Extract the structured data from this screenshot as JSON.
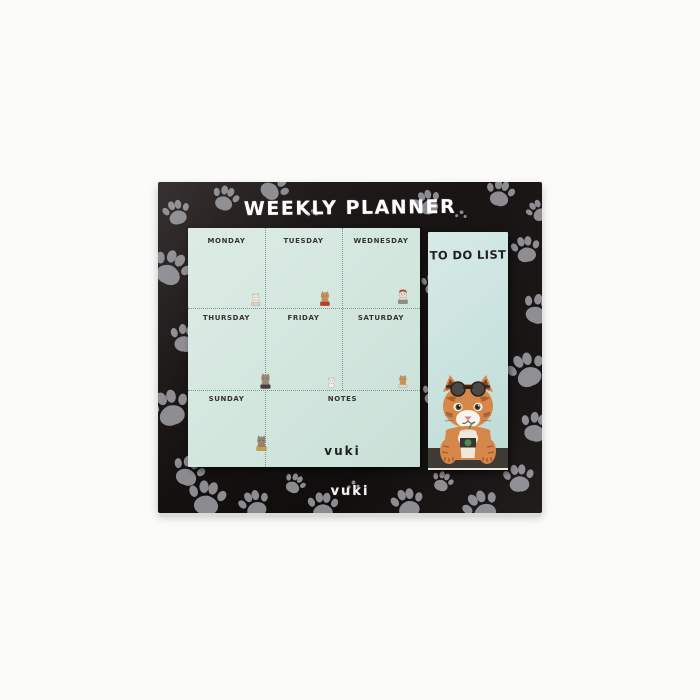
{
  "board": {
    "title": "WEEKLY PLANNER",
    "brand": "vuki"
  },
  "planner": {
    "days": [
      "MONDAY",
      "TUESDAY",
      "WEDNESDAY",
      "THURSDAY",
      "FRIDAY",
      "SATURDAY",
      "SUNDAY"
    ],
    "notes_label": "NOTES",
    "brand": "vuki"
  },
  "todo": {
    "title": "TO DO LIST"
  },
  "colors": {
    "board_background": "#151111",
    "paw_gray": "#8c8b90",
    "planner_pad": "#d3e6de",
    "todo_pad": "#c9e2de",
    "todo_band": "#3e3a35",
    "title_white": "#ffffff",
    "label_dark": "#35342f",
    "cat_orange": "#d6874a",
    "cup_label_green": "#4d8b57"
  },
  "decor": {
    "paws": [
      {
        "x": 4,
        "y": 16,
        "s": 30,
        "r": -15,
        "t": "paw"
      },
      {
        "x": -8,
        "y": 66,
        "s": 42,
        "r": 25,
        "t": "paw"
      },
      {
        "x": 10,
        "y": 140,
        "s": 34,
        "r": 8,
        "t": "paw"
      },
      {
        "x": -10,
        "y": 205,
        "s": 44,
        "r": -18,
        "t": "paw"
      },
      {
        "x": 12,
        "y": 272,
        "s": 36,
        "r": 20,
        "t": "paw"
      },
      {
        "x": 52,
        "y": 2,
        "s": 30,
        "r": 18,
        "t": "paw"
      },
      {
        "x": 98,
        "y": -12,
        "s": 34,
        "r": 40,
        "t": "paw"
      },
      {
        "x": 148,
        "y": 22,
        "s": 13,
        "r": 0,
        "t": "dots"
      },
      {
        "x": 255,
        "y": 6,
        "s": 30,
        "r": -22,
        "t": "paw"
      },
      {
        "x": 296,
        "y": 24,
        "s": 14,
        "r": 10,
        "t": "dots"
      },
      {
        "x": 326,
        "y": -4,
        "s": 32,
        "r": 12,
        "t": "paw"
      },
      {
        "x": 368,
        "y": 16,
        "s": 26,
        "r": -30,
        "t": "paw"
      },
      {
        "x": 352,
        "y": 52,
        "s": 32,
        "r": -10,
        "t": "paw"
      },
      {
        "x": 362,
        "y": 110,
        "s": 36,
        "r": 22,
        "t": "paw"
      },
      {
        "x": 348,
        "y": 168,
        "s": 42,
        "r": -22,
        "t": "paw"
      },
      {
        "x": 360,
        "y": 228,
        "s": 36,
        "r": 14,
        "t": "paw"
      },
      {
        "x": 344,
        "y": 280,
        "s": 34,
        "r": -6,
        "t": "paw"
      },
      {
        "x": 28,
        "y": 296,
        "s": 42,
        "r": 8,
        "t": "paw"
      },
      {
        "x": 80,
        "y": 306,
        "s": 34,
        "r": -20,
        "t": "paw"
      },
      {
        "x": 124,
        "y": 290,
        "s": 24,
        "r": 28,
        "t": "paw"
      },
      {
        "x": 148,
        "y": 308,
        "s": 34,
        "r": 0,
        "t": "paw"
      },
      {
        "x": 188,
        "y": 294,
        "s": 15,
        "r": 0,
        "t": "dots"
      },
      {
        "x": 232,
        "y": 304,
        "s": 36,
        "r": -14,
        "t": "paw"
      },
      {
        "x": 272,
        "y": 288,
        "s": 24,
        "r": 20,
        "t": "paw"
      },
      {
        "x": 304,
        "y": 306,
        "s": 40,
        "r": -28,
        "t": "paw"
      },
      {
        "x": 262,
        "y": 90,
        "s": 26,
        "r": 0,
        "t": "paw"
      },
      {
        "x": 262,
        "y": 200,
        "s": 26,
        "r": 15,
        "t": "paw"
      }
    ],
    "stickers": [
      {
        "x": 60,
        "y": 64,
        "s": 15,
        "body": "#f1ece2",
        "acc": "#d9d2c4",
        "hat": null,
        "name": "white-cat-sticker"
      },
      {
        "x": 128,
        "y": 62,
        "s": 17,
        "body": "#cb9154",
        "acc": "#c23b2a",
        "hat": null,
        "name": "reading-cat-sticker"
      },
      {
        "x": 206,
        "y": 60,
        "s": 17,
        "body": "#e8dfd2",
        "acc": "#8e8d89",
        "hat": "#b0462c",
        "name": "red-hat-cat-sticker"
      },
      {
        "x": 68,
        "y": 144,
        "s": 18,
        "body": "#9c8a76",
        "acc": "#46413c",
        "hat": null,
        "name": "laptop-cat-sticker"
      },
      {
        "x": 136,
        "y": 147,
        "s": 14,
        "body": "#f3efe6",
        "acc": null,
        "hat": null,
        "name": "white-cat-sticker"
      },
      {
        "x": 207,
        "y": 146,
        "s": 15,
        "body": "#cf9357",
        "acc": "#e3d7c4",
        "hat": null,
        "name": "tabby-cat-sticker"
      },
      {
        "x": 64,
        "y": 206,
        "s": 18,
        "body": "#97856f",
        "acc": "#c8a23c",
        "hat": null,
        "name": "sign-cat-sticker"
      }
    ]
  }
}
